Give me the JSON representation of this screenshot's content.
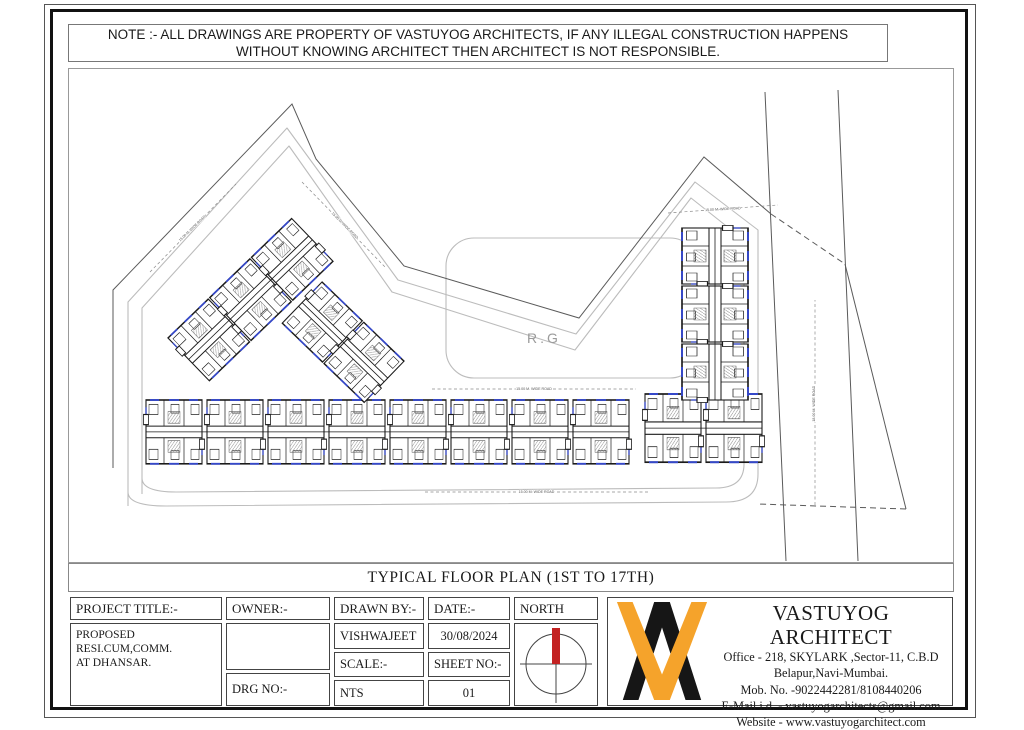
{
  "note": {
    "line1": "NOTE :- ALL DRAWINGS ARE PROPERTY OF VASTUYOG ARCHITECTS, IF ANY ILLEGAL CONSTRUCTION HAPPENS",
    "line2": "WITHOUT KNOWING ARCHITECT THEN ARCHITECT IS NOT RESPONSIBLE."
  },
  "drawing_title": "TYPICAL FLOOR PLAN (1ST TO 17TH)",
  "title_block": {
    "project_title_label": "PROJECT TITLE:-",
    "project_title_line1": "PROPOSED RESI.CUM,COMM.",
    "project_title_line2": "AT  DHANSAR.",
    "owner_label": "OWNER:-",
    "drg_no_label": "DRG NO:-",
    "drawn_by_label": "DRAWN BY:-",
    "drawn_by_value": "VISHWAJEET",
    "scale_label": "SCALE:-",
    "scale_value": "NTS",
    "date_label": "DATE:-",
    "date_value": "30/08/2024",
    "sheet_no_label": "SHEET NO:-",
    "sheet_no_value": "01",
    "north_label": "NORTH"
  },
  "architect": {
    "name": "VASTUYOG ARCHITECT",
    "address1": "Office - 218, SKYLARK ,Sector-11, C.B.D",
    "address2": "Belapur,Navi-Mumbai.",
    "mobile": "Mob. No. -9022442281/8108440206",
    "email": "E-Mail i.d. - vastuyogarchitects@gmail.com",
    "website": "Website - www.vastuyogarchitect.com"
  },
  "colors": {
    "note_red": "#d93025",
    "needle_red": "#c32222",
    "logo_orange": "#f5a32b",
    "logo_black": "#161616",
    "plan_blue": "#3548c9"
  },
  "site_plan": {
    "rg_label": "R.G",
    "boundary": [
      {
        "pts": [
          [
            113,
            468
          ],
          [
            113,
            290
          ],
          [
            292,
            104
          ],
          [
            316,
            159
          ],
          [
            404,
            266
          ],
          [
            579,
            318
          ],
          [
            704,
            157
          ],
          [
            771,
            214
          ]
        ],
        "dash": false
      },
      {
        "pts": [
          [
            771,
            214
          ],
          [
            845,
            264
          ]
        ],
        "dash": true
      },
      {
        "pts": [
          [
            845,
            264
          ],
          [
            906,
            509
          ]
        ],
        "dash": false
      },
      {
        "pts": [
          [
            906,
            509
          ],
          [
            758,
            504
          ]
        ],
        "dash": true
      },
      {
        "pts": [
          [
            765,
            92
          ],
          [
            786,
            561
          ]
        ],
        "dash": false
      },
      {
        "pts": [
          [
            838,
            90
          ],
          [
            858,
            561
          ]
        ],
        "dash": false
      }
    ],
    "roads": [
      "M128,506 L128,302 L287,128 L398,280 L576,334 L695,182 L758,230 L758,474 Q758,502 726,502 L166,506 Q128,506 128,492",
      "M142,494 L142,308 L289,146 L392,292 L575,350 L691,198 L744,240 L744,464 Q744,488 716,488 L176,492 Q142,492 142,478"
    ],
    "rg_box": {
      "x": 446,
      "y": 238,
      "w": 252,
      "h": 140,
      "rx": 28
    },
    "road_labels": [
      {
        "x1": 150,
        "y1": 272,
        "x2": 236,
        "y2": 184,
        "rot": -44,
        "label": "15.00 M. WIDE ROAD"
      },
      {
        "x1": 302,
        "y1": 182,
        "x2": 386,
        "y2": 268,
        "rot": 45,
        "label": "15.00 M. WIDE ROAD"
      },
      {
        "x1": 668,
        "y1": 213,
        "x2": 778,
        "y2": 205,
        "rot": -3,
        "label": "15.00 M. WIDE ROAD"
      },
      {
        "x1": 432,
        "y1": 389,
        "x2": 636,
        "y2": 389,
        "rot": 0,
        "label": "15.00 M. WIDE ROAD"
      },
      {
        "x1": 425,
        "y1": 492,
        "x2": 648,
        "y2": 492,
        "rot": 0,
        "label": "15.00 M. WIDE ROAD"
      },
      {
        "x1": 815,
        "y1": 505,
        "x2": 815,
        "y2": 300,
        "rot": -90,
        "label": "18.00 M. WIDE ROAD"
      }
    ],
    "clusters": [
      {
        "x": 146,
        "y": 400,
        "rot": 0,
        "count": 8,
        "dx": 61,
        "sx": 1.0,
        "sy": 1.45
      },
      {
        "x": 645,
        "y": 394,
        "rot": 0,
        "count": 2,
        "dx": 61,
        "sx": 1.0,
        "sy": 1.55
      },
      {
        "x": 748,
        "y": 228,
        "rot": 90,
        "count": 3,
        "dx": 58,
        "sx": 1.0,
        "sy": 1.5
      },
      {
        "x": 168,
        "y": 338,
        "rot": -44,
        "count": 3,
        "dx": 58,
        "sx": 1.0,
        "sy": 1.35
      },
      {
        "x": 322,
        "y": 282,
        "rot": 44,
        "count": 2,
        "dx": 58,
        "sx": 1.0,
        "sy": 1.3
      }
    ]
  }
}
